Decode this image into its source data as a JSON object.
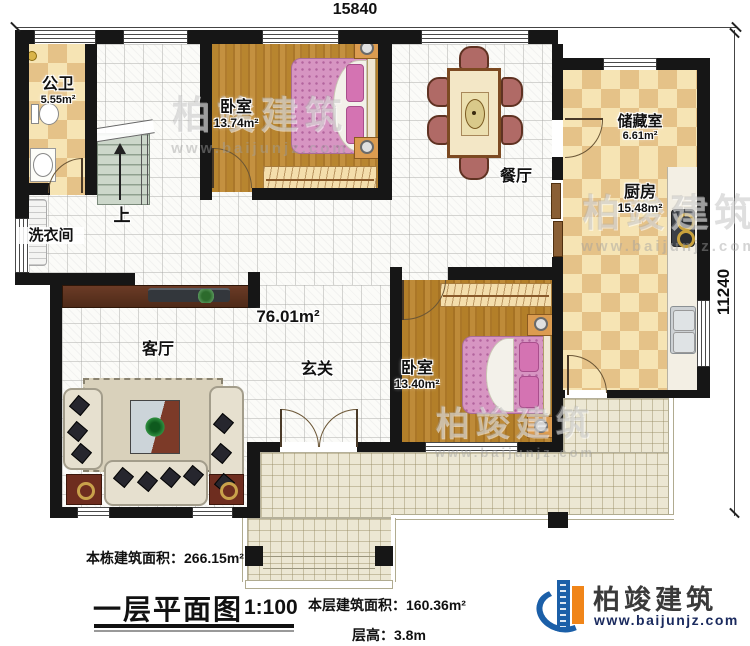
{
  "plan": {
    "dimensions": {
      "top": "15840",
      "right": "11240"
    },
    "rooms": {
      "bathroom": {
        "name": "公卫",
        "area": "5.55m²"
      },
      "bedroom1": {
        "name": "卧室",
        "area": "13.74m²"
      },
      "dining": {
        "name": "餐厅"
      },
      "storage": {
        "name": "储藏室",
        "area": "6.61m²"
      },
      "kitchen": {
        "name": "厨房",
        "area": "15.48m²"
      },
      "laundry": {
        "name": "洗衣间"
      },
      "living": {
        "name": "客厅"
      },
      "entry": {
        "name": "玄关"
      },
      "bedroom2": {
        "name": "卧室",
        "area": "13.40m²"
      },
      "open_area": {
        "value": "76.01m²"
      },
      "stairs": {
        "up_label": "上"
      }
    },
    "footer": {
      "total_area_label": "本栋建筑面积：266.15m²",
      "floor_title": "一层平面图",
      "scale": "1:100",
      "floor_area_label": "本层建筑面积：160.36m²",
      "floor_height_label": "层高：3.8m"
    },
    "branding": {
      "company": "柏竣建筑",
      "website": "www.baijunjz.com"
    },
    "watermark": {
      "text": "柏竣建筑",
      "url": "www.baijunjz.com"
    },
    "colors": {
      "wall": "#161616",
      "checker_tan": "#e5c288",
      "checker_cream": "#f6e4b4",
      "wood": "#b8852f",
      "bed_pink": "#d795c2",
      "hall_tile": "#fbfbf8",
      "terrace": "#ece7d3",
      "logo_blue": "#1b5fa8",
      "logo_orange": "#f08519"
    }
  }
}
